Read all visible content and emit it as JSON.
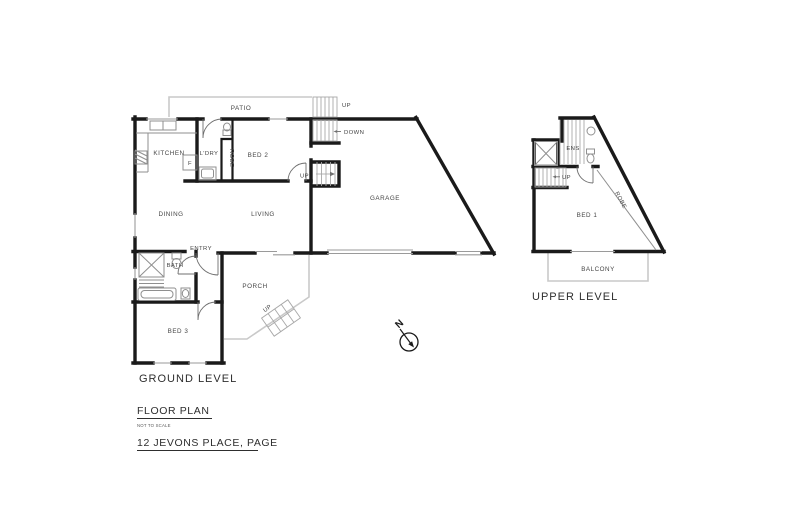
{
  "plan": {
    "ground": {
      "title": "GROUND LEVEL",
      "rooms": {
        "patio": "PATIO",
        "kitchen": "KITCHEN",
        "laundry": "L'DRY",
        "bed2": "BED 2",
        "robe": "ROBE",
        "garage": "GARAGE",
        "dining": "DINING",
        "living": "LIVING",
        "entry": "ENTRY",
        "bath": "BATH",
        "bed3": "BED 3",
        "porch": "PORCH"
      },
      "fixtures": {
        "fridge": "F"
      },
      "stairs": {
        "patio_up": "UP",
        "garage_down": "DOWN",
        "living_up": "UP",
        "porch_up": "UP"
      }
    },
    "upper": {
      "title": "UPPER LEVEL",
      "rooms": {
        "ensuite": "ENS",
        "bed1": "BED 1",
        "robe": "ROBE",
        "balcony": "BALCONY"
      },
      "stairs": {
        "up": "UP"
      }
    },
    "compass": {
      "north": "N"
    }
  },
  "footer": {
    "plan_title": "FLOOR PLAN",
    "scale_note": "NOT TO SCALE",
    "address": "12 JEVONS PLACE, PAGE"
  },
  "colors": {
    "wall": "#1a1a1a",
    "outdoor_outline": "#c9c9c9",
    "fixture": "#8f8f8f",
    "label": "#454545",
    "title": "#2e2e2e",
    "background": "#ffffff"
  }
}
